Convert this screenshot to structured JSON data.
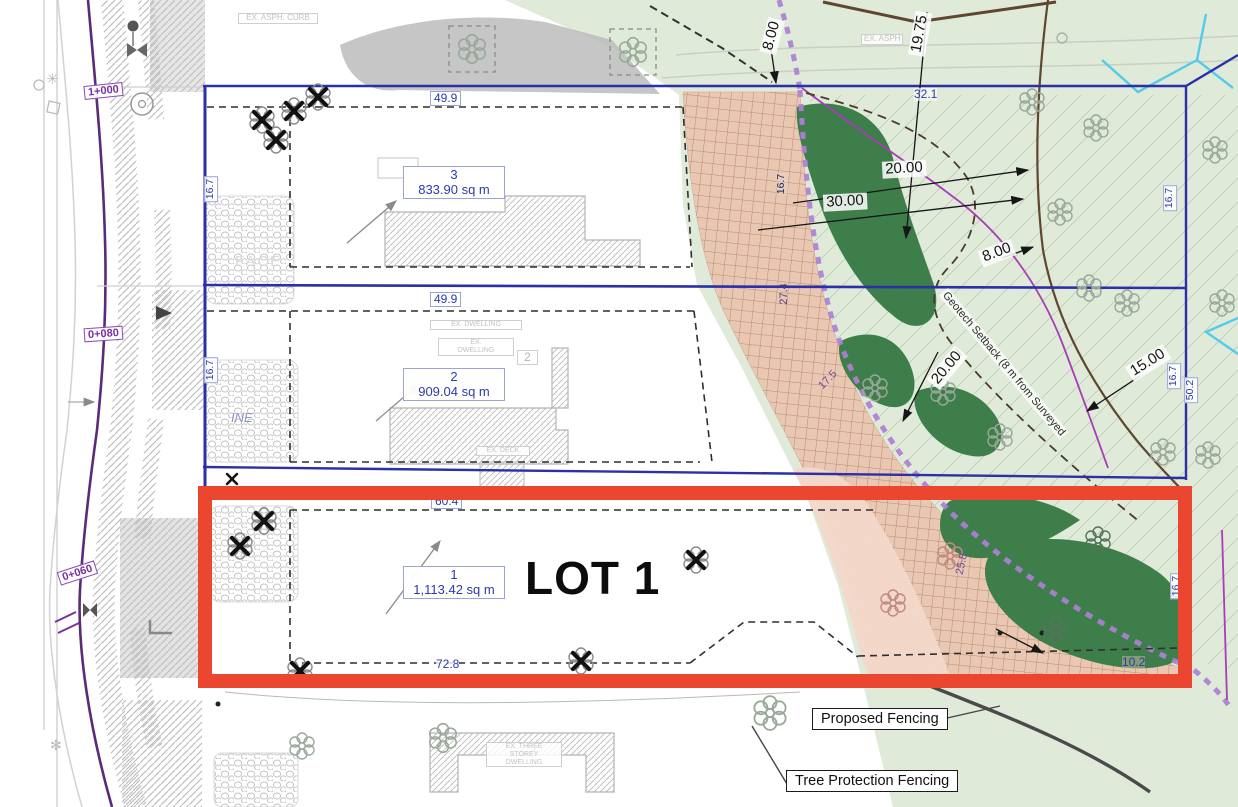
{
  "colors": {
    "boundary_blue": "#2b2fa8",
    "highlight_red": "#ea4630",
    "fence_purple": "#ae7fd6",
    "vegetation_green": "#3e7e4b",
    "setback_salmon": "#e9c7b2",
    "background_mint": "#dfead8",
    "label_blue": "#2b3ba8",
    "road_purple": "#5b2a7a"
  },
  "lots": {
    "lot1": {
      "number": "1",
      "area": "1,113.42 sq m",
      "title": "LOT 1"
    },
    "lot2": {
      "number": "2",
      "area": "909.04 sq m"
    },
    "lot3": {
      "number": "3",
      "area": "833.90 sq m"
    }
  },
  "dims": {
    "w3": "49.9",
    "w2": "49.9",
    "w1": "60.4",
    "d72": "72.8",
    "d10": "10.2",
    "d32": "32.1",
    "d8a": "8.00",
    "d19": "19.75",
    "d20a": "20.00",
    "d30": "30.00",
    "d8b": "8.00",
    "d20b": "20.00",
    "d15": "15.00",
    "s16a": "16.7",
    "s16b": "16.7",
    "s16c": "16.7",
    "s16d": "16.7",
    "s16e": "16.7",
    "s16f": "16.7",
    "s50": "50.2",
    "s27": "27.4",
    "s17": "17.5",
    "s25": "25.8"
  },
  "stations": {
    "a": "1+000",
    "b": "0+080",
    "c": "0+060"
  },
  "notes": {
    "geotech": "Geotech Setback (8 m from Surveyed",
    "asph_curb": "EX. ASPH. CURB",
    "pvc": "EX. 450 PVC",
    "asph": "EX. ASPH",
    "dwelling": "EX. DWELLING",
    "dwelling_l1": "EX.",
    "dwelling_l2": "DWELLING",
    "deck": "EX. DECK",
    "storey_l1": "EX. THREE",
    "storey_l2": "STOREY",
    "storey_l3": "DWELLING",
    "face": "FACE",
    "ine": "INE",
    "tag2": "2"
  },
  "legend": {
    "proposed": "Proposed Fencing",
    "tree_protection": "Tree Protection Fencing"
  }
}
